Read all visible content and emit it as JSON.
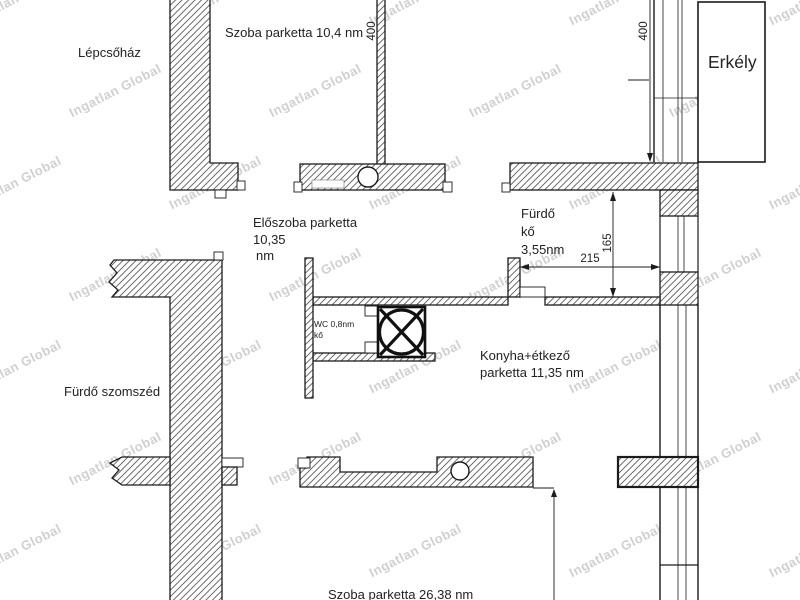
{
  "watermark": {
    "text": "Ingatlan Global"
  },
  "labels": {
    "stairwell": "Lépcsőház",
    "room_top": "Szoba parketta 10,4 nm",
    "hall_l1": "Előszoba parketta",
    "hall_l2": "10,35",
    "hall_l3": "nm",
    "bath_l1": "Fürdő",
    "bath_l2": "kő",
    "bath_l3": "3,55nm",
    "wc_l1": "WC 0,8nm",
    "wc_l2": "kő",
    "kitchen_l1": "Konyha+étkező",
    "kitchen_l2": "parketta 11,35 nm",
    "neighbor": "Fürdő szomszéd",
    "balcony": "Erkély",
    "room_bottom": "Szoba parketta 26,38 nm"
  },
  "dimensions": {
    "top_left": "400",
    "top_right": "400",
    "bath_width": "215",
    "bath_height": "165"
  }
}
